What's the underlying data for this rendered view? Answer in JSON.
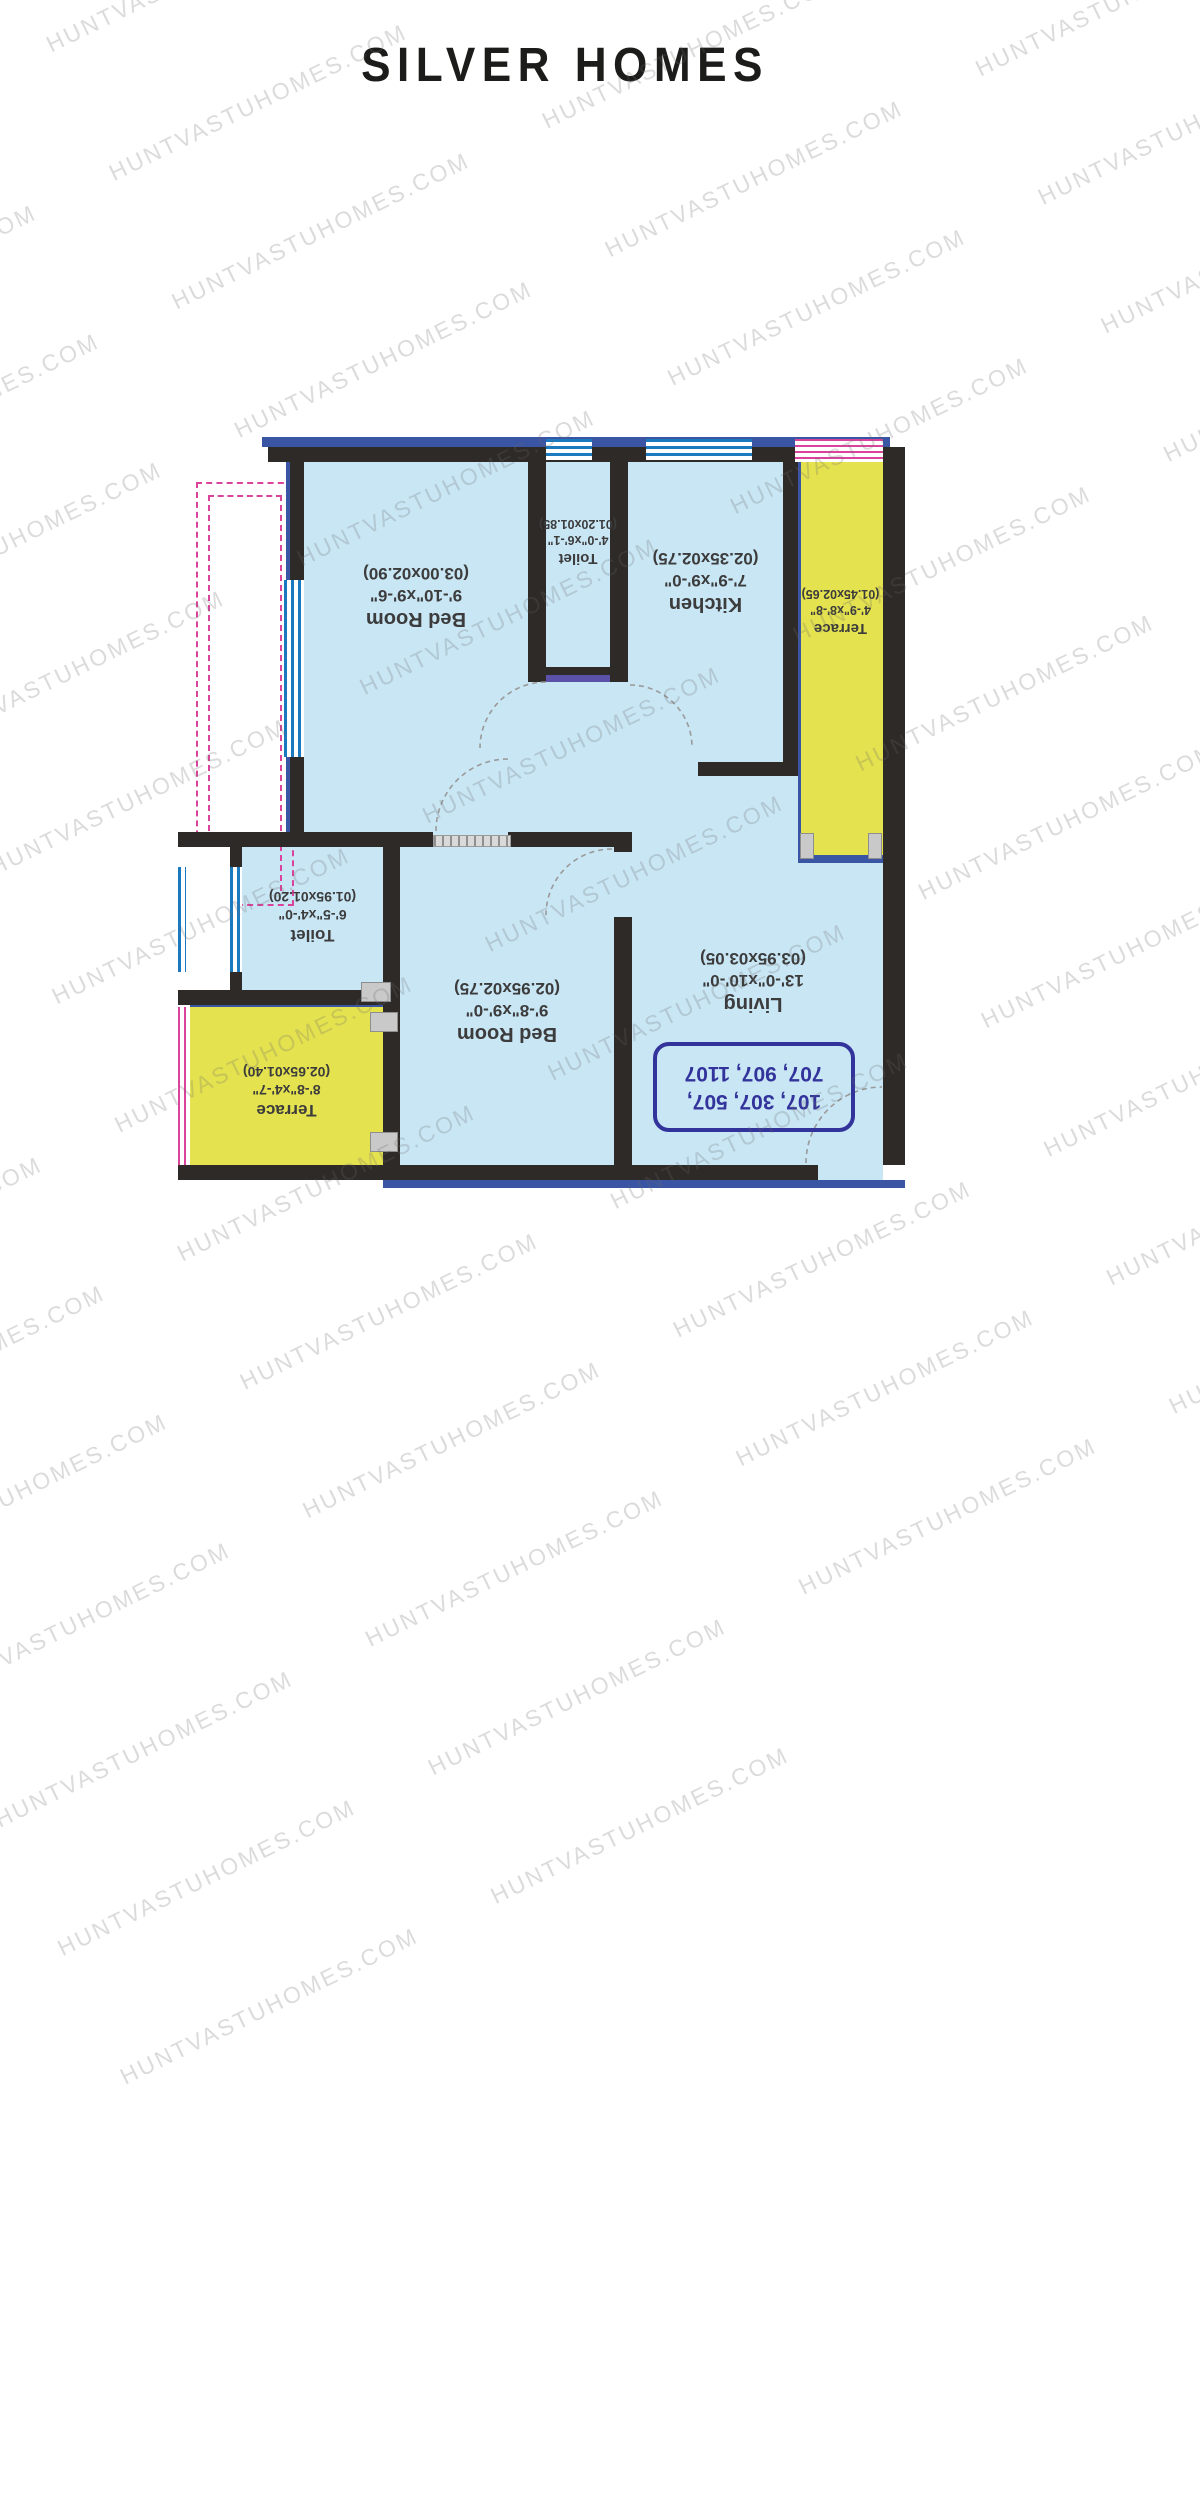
{
  "title": "SILVER HOMES",
  "watermark": "HUNTVASTUHOMES.COM",
  "plan": {
    "rooms": {
      "bedroom1": {
        "name": "Bed Room",
        "size_ft": "9'-10\"x9'-6\"",
        "size_m": "(03.00x02.90)"
      },
      "toilet1": {
        "name": "Toilet",
        "size_ft": "4'-0\"x6'-1\"",
        "size_m": "(01.20x01.85)"
      },
      "kitchen": {
        "name": "Kitchen",
        "size_ft": "7'-9\"x9'-0\"",
        "size_m": "(02.35x02.75)"
      },
      "terrace_right": {
        "name": "Terrace",
        "size_ft": "4'-9\"x8'-8\"",
        "size_m": "(01.45x02.65)"
      },
      "toilet2": {
        "name": "Toilet",
        "size_ft": "6'-5\"x4'-0\"",
        "size_m": "(01.95x01.20)"
      },
      "bedroom2": {
        "name": "Bed Room",
        "size_ft": "9'-8\"x9'-0\"",
        "size_m": "(02.95x02.75)"
      },
      "living": {
        "name": "Living",
        "size_ft": "13'-0\"x10'-0\"",
        "size_m": "(03.95x03.05)"
      },
      "terrace_left": {
        "name": "Terrace",
        "size_ft": "8'-8\"x4'-7\"",
        "size_m": "(02.65x01.40)"
      }
    },
    "units": {
      "line1": "107, 307, 507,",
      "line2": "707, 907, 1107"
    },
    "colors": {
      "floor": "#c9e6f5",
      "terrace": "#e4e24f",
      "wall": "#2e2a27",
      "outline": "#3a55a4",
      "window": "#1b79c0",
      "railing": "#d9439b",
      "unit_text": "#32339b",
      "label": "#3c3c3c"
    }
  }
}
